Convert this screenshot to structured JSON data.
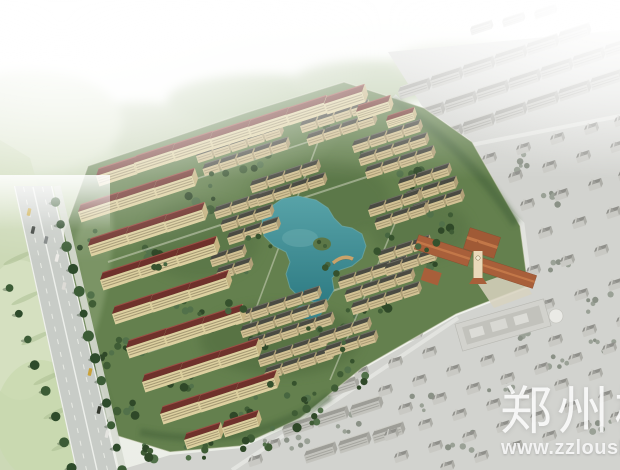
{
  "watermark": {
    "logo_text": "郑州楼",
    "url_text": "www.zzloushi"
  },
  "palette": {
    "lake_water": "#47949b",
    "apartment_roof": "#6f312b",
    "townhouse_roof": "#4a4a42",
    "apartment_facade": "#ddd0a0",
    "townhouse_facade": "#d2c194",
    "clubhouse_roof": "#a85f3a",
    "surroundings_gray": "#d2d3cf",
    "field_green": "#ccd9b6",
    "tree_green": "#41602f",
    "road_gray": "#c8ccc7"
  }
}
